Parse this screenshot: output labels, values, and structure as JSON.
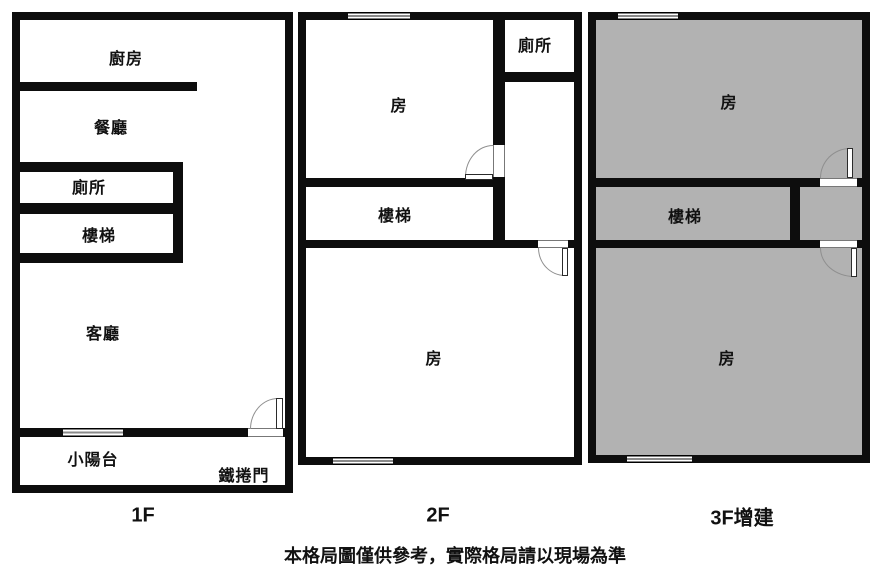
{
  "note": "本格局圖僅供參考，實際格局請以現場為準",
  "floors": [
    {
      "label": "1F",
      "rooms": {
        "kitchen": "廚房",
        "dining": "餐廳",
        "toilet": "廁所",
        "stairs": "樓梯",
        "living": "客廳",
        "balcony": "小陽台",
        "roller_door": "鐵捲門"
      }
    },
    {
      "label": "2F",
      "rooms": {
        "room_top": "房",
        "toilet": "廁所",
        "stairs": "樓梯",
        "room_bottom": "房"
      }
    },
    {
      "label": "3F增建",
      "rooms": {
        "room_top": "房",
        "stairs": "樓梯",
        "room_bottom": "房"
      }
    }
  ],
  "colors": {
    "wall": "#0d0d0d",
    "addition_fill": "#b2b2b2",
    "background": "#ffffff",
    "door_arc": "#8f8f8f"
  }
}
